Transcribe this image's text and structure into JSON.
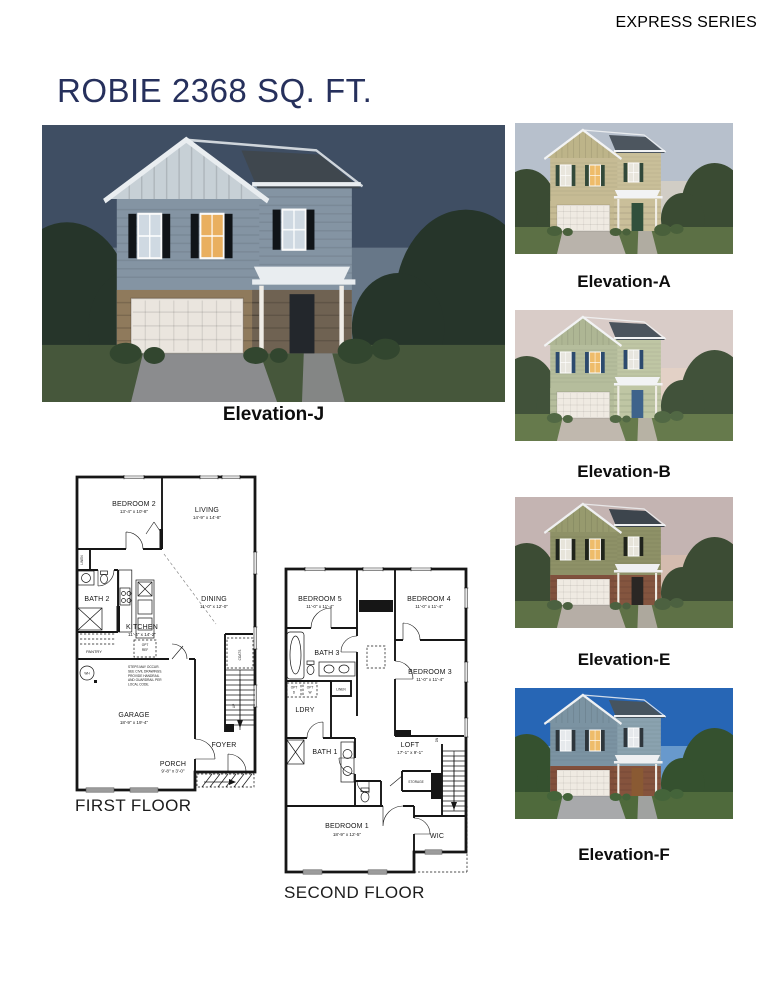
{
  "header": {
    "series": "EXPRESS SERIES",
    "title": "ROBIE 2368 SQ. FT.",
    "title_color": "#26305c"
  },
  "main_elevation": {
    "label": "Elevation-J"
  },
  "thumbnails": [
    {
      "label": "Elevation-A"
    },
    {
      "label": "Elevation-B"
    },
    {
      "label": "Elevation-E"
    },
    {
      "label": "Elevation-F"
    }
  ],
  "palettes": {
    "j": {
      "sky": "#3f4e63",
      "glow": "#8fa0ae",
      "tree": "#26352a",
      "bush": "#32462f",
      "grass": "#46573b",
      "drive": "#8b8c8e",
      "siding": "#8494a3",
      "gable": "#c7d0d6",
      "siding2": "#8494a3",
      "roof": "#3f474e",
      "base": "#8f7a5c",
      "base2": "#6f6252",
      "garage": "#eae5de",
      "door": "#23272c",
      "shutter": "#101418",
      "win": "#cfd9e2",
      "winlit": "#e9af5f",
      "trim": "#e9edf0",
      "post": "#efece6"
    },
    "a": {
      "sky": "#b7c0cc",
      "glow": "#ecd9bd",
      "tree": "#3a4b33",
      "bush": "#49603b",
      "grass": "#5c7045",
      "drive": "#b9b3ab",
      "siding": "#c6bb94",
      "gable": "#bdb489",
      "siding2": "#c9bf99",
      "roof": "#4d565f",
      "base": "#c6bb94",
      "base2": "#cabf9a",
      "garage": "#efeae2",
      "door": "#31503c",
      "shutter": "#32493a",
      "win": "#e9e6dd",
      "winlit": "#eebc6a",
      "trim": "#f2f3f4",
      "post": "#f0ede6"
    },
    "b": {
      "sky": "#d9ccc8",
      "glow": "#eed6c4",
      "tree": "#41523a",
      "bush": "#516844",
      "grass": "#667a4c",
      "drive": "#c0b8ae",
      "siding": "#b5bd9c",
      "gable": "#aeb694",
      "siding2": "#bfc6a4",
      "roof": "#4b545d",
      "base": "#b5bd9c",
      "base2": "#bfc6a4",
      "garage": "#efeae2",
      "door": "#3e638b",
      "shutter": "#2c4a6e",
      "win": "#e8e6df",
      "winlit": "#eebc6a",
      "trim": "#f2f3f4",
      "post": "#f0ede6"
    },
    "e": {
      "sky": "#c4b4b2",
      "glow": "#e3c3ab",
      "tree": "#3c4c34",
      "bush": "#4c6140",
      "grass": "#5e7146",
      "drive": "#b6aea6",
      "siding": "#8e9167",
      "gable": "#979a6e",
      "siding2": "#8e9167",
      "roof": "#3d454d",
      "base": "#80513d",
      "base2": "#84553f",
      "garage": "#efeae2",
      "door": "#2a2724",
      "shutter": "#20241c",
      "win": "#e7e4da",
      "winlit": "#eebc6a",
      "trim": "#eff0f1",
      "post": "#efece5"
    },
    "f": {
      "sky": "#2766b5",
      "glow": "#aacbe4",
      "tree": "#35512f",
      "bush": "#44643a",
      "grass": "#4f6a3c",
      "drive": "#a8a9ab",
      "siding": "#7b93a2",
      "gable": "#7b93a2",
      "siding2": "#8aa2af",
      "roof": "#46545f",
      "base": "#814f3b",
      "base2": "#85533d",
      "garage": "#efeae2",
      "door": "#8a5a33",
      "shutter": "#2e363c",
      "win": "#e6e9ec",
      "winlit": "#eebc6a",
      "trim": "#eef0f2",
      "post": "#efece6"
    }
  },
  "first_floor": {
    "title": "FIRST FLOOR",
    "rooms": {
      "bedroom2": {
        "name": "BEDROOM 2",
        "dims": "13'-4\" x 10'-8\""
      },
      "living": {
        "name": "LIVING",
        "dims": "14'-9\" x 14'-8\""
      },
      "bath2": {
        "name": "BATH 2"
      },
      "dining": {
        "name": "DINING",
        "dims": "11'-0\" x 12'-0\""
      },
      "kitchen": {
        "name": "KITCHEN",
        "dims": "11'-4\" x 14'-2\""
      },
      "pantry": {
        "name": "PANTRY"
      },
      "linen": {
        "name": "LINEN"
      },
      "coats": {
        "name": "COATS"
      },
      "opt_ref": {
        "l1": "OPT",
        "l2": "REF"
      },
      "wh": {
        "name": "WH"
      },
      "garage": {
        "name": "GARAGE",
        "dims": "18'-9\" x 19'-4\""
      },
      "foyer": {
        "name": "FOYER"
      },
      "porch": {
        "name": "PORCH",
        "dims": "9'-8\" x 3'-0\""
      },
      "up": {
        "name": "UP"
      }
    },
    "note_lines": [
      "STEPS MAY OCCUR.",
      "SEE CIVIL DRAWINGS.",
      "PROVIDE HANDRAIL",
      "AND GUARDRAIL PER",
      "LOCAL CODE."
    ]
  },
  "second_floor": {
    "title": "SECOND FLOOR",
    "rooms": {
      "bedroom5": {
        "name": "BEDROOM 5",
        "dims": "11'-0\" x 11'-4\""
      },
      "bedroom4": {
        "name": "BEDROOM 4",
        "dims": "11'-0\" x 11'-4\""
      },
      "bath3": {
        "name": "BATH 3"
      },
      "bedroom3": {
        "name": "BEDROOM 3",
        "dims": "11'-0\" x 11'-4\""
      },
      "ldry": {
        "name": "LDRY"
      },
      "linen": {
        "name": "LINEN"
      },
      "opt_d": {
        "l1": "OPT",
        "l2": "D"
      },
      "opt_w": {
        "l1": "OPT",
        "l2": "W"
      },
      "bath1": {
        "name": "BATH 1"
      },
      "loft": {
        "name": "LOFT",
        "dims": "17'-1\" x 9'-1\""
      },
      "storage": {
        "name": "STORAGE"
      },
      "dn": {
        "name": "DN"
      },
      "bedroom1": {
        "name": "BEDROOM 1",
        "dims": "18'-9\" x 12'-5\""
      },
      "wic": {
        "name": "WIC"
      }
    }
  }
}
